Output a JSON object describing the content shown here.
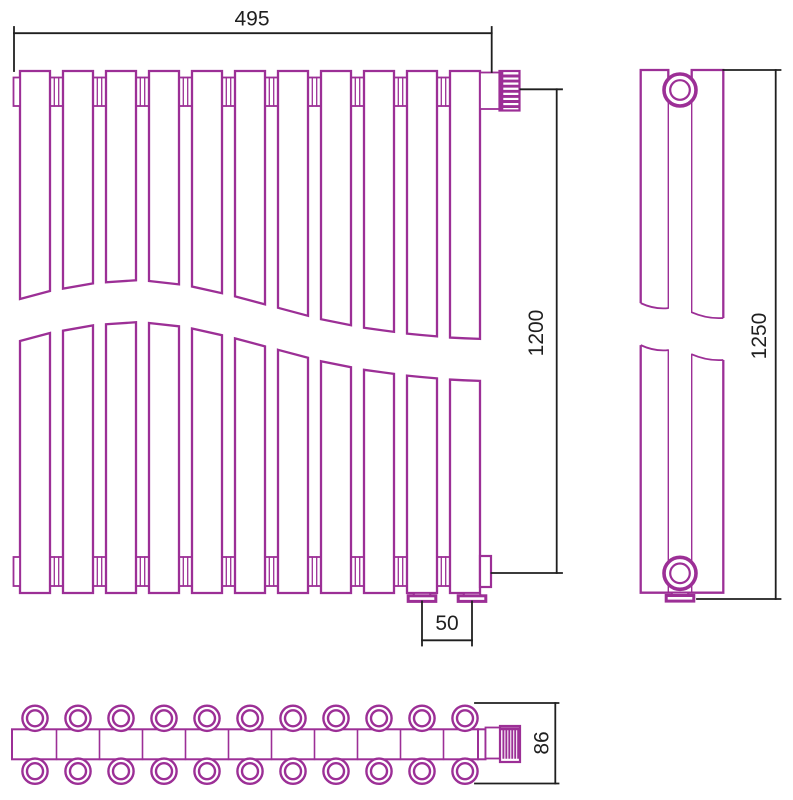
{
  "drawing": {
    "line_color": "#9c2f96",
    "dim_color": "#1f1f1f",
    "background": "#ffffff",
    "front_view": {
      "columns": 11,
      "top_connectors": 10,
      "bottom_connectors": 10,
      "feet": 2,
      "valve": "ribbed-knob-top-right"
    },
    "side_view": {
      "tubes": 2,
      "mounting_brackets": 2,
      "foot": 1
    },
    "bottom_view": {
      "sections": 11,
      "front_row_tubes": 11,
      "back_row_tubes": 11,
      "valve": "ribbed-knob-right"
    },
    "dimensions": {
      "width": {
        "label": "495"
      },
      "connection_height": {
        "label": "1200"
      },
      "overall_height": {
        "label": "1250"
      },
      "outlet_spacing": {
        "label": "50"
      },
      "depth": {
        "label": "86"
      }
    }
  }
}
